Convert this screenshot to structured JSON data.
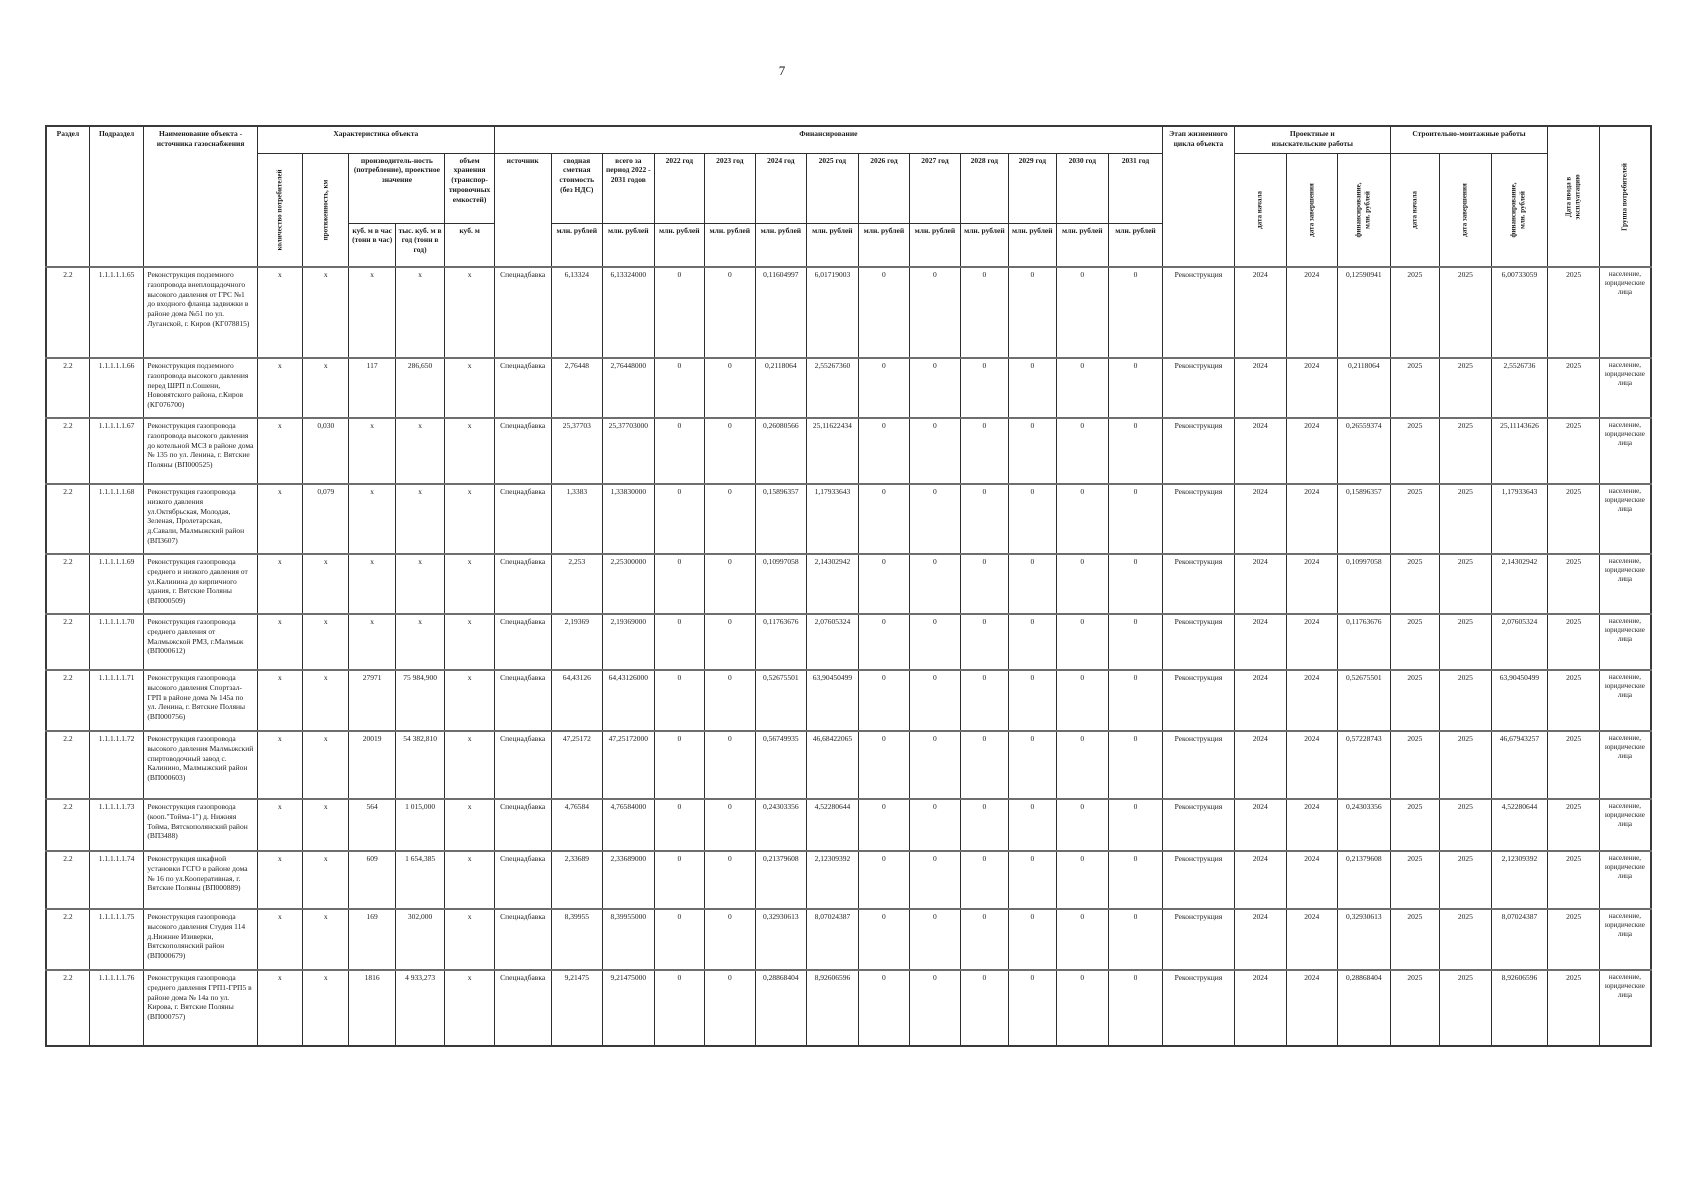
{
  "page_number": "7",
  "table": {
    "header": {
      "razdel": "Раздел",
      "podrazdel": "Подраздел",
      "object_name": "Наименование объекта - источника газоснабжения",
      "characteristics": "Характеристика объекта",
      "consumers_count": "количество потребителей",
      "length_km": "протяженность, км",
      "productivity": "производитель-ность (потребление), проектное значение",
      "m3_per_hour": "куб. м в час (тонн в час)",
      "thous_m3_per_year": "тыс. куб. м в год (тонн в год)",
      "storage_volume": "объем хранения (транспор-тировочных емкостей)",
      "m3": "куб. м",
      "financing": "Финансирование",
      "source": "источник",
      "estimated_cost": "сводная сметная стоимость (без НДС)",
      "total_period": "всего за период 2022 - 2031 годов",
      "mln_rub": "млн. рублей",
      "years": [
        "2022 год",
        "2023 год",
        "2024 год",
        "2025 год",
        "2026 год",
        "2027 год",
        "2028 год",
        "2029 год",
        "2030 год",
        "2031 год"
      ],
      "lifecycle_stage": "Этап жизненного цикла объекта",
      "survey_works": "Проектные и изыскательские работы",
      "construction_works": "Строительно-монтажные работы",
      "start_date": "дата начала",
      "end_date": "дата завершения",
      "financing_mln": "финансирование, млн. рублей",
      "commissioning_date": "Дата ввода в эксплуатацию",
      "consumer_group": "Группа потребителей"
    },
    "rows": [
      {
        "razdel": "2.2",
        "podrazdel": "1.1.1.1.1.65",
        "name": "Реконструкция подземного газопровода внеплощадочного высокого давления от ГРС №1 до входного фланца задвижки  в районе дома №51 по ул. Луганской, г. Киров (КГ078815)",
        "consumers": "х",
        "length": "х",
        "m3h": "х",
        "tm3y": "х",
        "storage": "х",
        "source": "Спецнадбавка",
        "cost": "6,13324",
        "total": "6,13324000",
        "y2022": "0",
        "y2023": "0",
        "y2024": "0,11604997",
        "y2025": "6,01719003",
        "y2026": "0",
        "y2027": "0",
        "y2028": "0",
        "y2029": "0",
        "y2030": "0",
        "y2031": "0",
        "stage": "Реконструкция",
        "pir_start": "2024",
        "pir_end": "2024",
        "pir_fin": "0,12590941",
        "smr_start": "2025",
        "smr_end": "2025",
        "smr_fin": "6,00733059",
        "commissioning": "2025",
        "group": "население, юридические лица"
      },
      {
        "razdel": "2.2",
        "podrazdel": "1.1.1.1.1.66",
        "name": "Реконструкция подземного газопровода высокого давления перед ШРП п.Сошени, Нововятского района, г.Киров (КГ076700)",
        "consumers": "х",
        "length": "х",
        "m3h": "117",
        "tm3y": "286,650",
        "storage": "х",
        "source": "Спецнадбавка",
        "cost": "2,76448",
        "total": "2,76448000",
        "y2022": "0",
        "y2023": "0",
        "y2024": "0,2118064",
        "y2025": "2,55267360",
        "y2026": "0",
        "y2027": "0",
        "y2028": "0",
        "y2029": "0",
        "y2030": "0",
        "y2031": "0",
        "stage": "Реконструкция",
        "pir_start": "2024",
        "pir_end": "2024",
        "pir_fin": "0,2118064",
        "smr_start": "2025",
        "smr_end": "2025",
        "smr_fin": "2,5526736",
        "commissioning": "2025",
        "group": "население, юридические лица"
      },
      {
        "razdel": "2.2",
        "podrazdel": "1.1.1.1.1.67",
        "name": "Реконструкция газопровода газопровода высокого давления до котельной МСЗ  в районе дома № 135 по ул. Ленина, г. Вятские Поляны (ВП000525)",
        "consumers": "х",
        "length": "0,030",
        "m3h": "х",
        "tm3y": "х",
        "storage": "х",
        "source": "Спецнадбавка",
        "cost": "25,37703",
        "total": "25,37703000",
        "y2022": "0",
        "y2023": "0",
        "y2024": "0,26080566",
        "y2025": "25,11622434",
        "y2026": "0",
        "y2027": "0",
        "y2028": "0",
        "y2029": "0",
        "y2030": "0",
        "y2031": "0",
        "stage": "Реконструкция",
        "pir_start": "2024",
        "pir_end": "2024",
        "pir_fin": "0,26559374",
        "smr_start": "2025",
        "smr_end": "2025",
        "smr_fin": "25,11143626",
        "commissioning": "2025",
        "group": "население, юридические лица"
      },
      {
        "razdel": "2.2",
        "podrazdel": "1.1.1.1.1.68",
        "name": "Реконструкция газопровода низкого давления ул.Октябрьская, Молодая, Зеленая, Пролетарская, д.Савали, Малмыжский район (ВП3607)",
        "consumers": "х",
        "length": "0,079",
        "m3h": "х",
        "tm3y": "х",
        "storage": "х",
        "source": "Спецнадбавка",
        "cost": "1,3383",
        "total": "1,33830000",
        "y2022": "0",
        "y2023": "0",
        "y2024": "0,15896357",
        "y2025": "1,17933643",
        "y2026": "0",
        "y2027": "0",
        "y2028": "0",
        "y2029": "0",
        "y2030": "0",
        "y2031": "0",
        "stage": "Реконструкция",
        "pir_start": "2024",
        "pir_end": "2024",
        "pir_fin": "0,15896357",
        "smr_start": "2025",
        "smr_end": "2025",
        "smr_fin": "1,17933643",
        "commissioning": "2025",
        "group": "население, юридические лица"
      },
      {
        "razdel": "2.2",
        "podrazdel": "1.1.1.1.1.69",
        "name": "Реконструкция газопровода среднего и низкого давления от ул.Калинина до кирпичного здания, г. Вятские Поляны (ВП000509)",
        "consumers": "х",
        "length": "х",
        "m3h": "х",
        "tm3y": "х",
        "storage": "х",
        "source": "Спецнадбавка",
        "cost": "2,253",
        "total": "2,25300000",
        "y2022": "0",
        "y2023": "0",
        "y2024": "0,10997058",
        "y2025": "2,14302942",
        "y2026": "0",
        "y2027": "0",
        "y2028": "0",
        "y2029": "0",
        "y2030": "0",
        "y2031": "0",
        "stage": "Реконструкция",
        "pir_start": "2024",
        "pir_end": "2024",
        "pir_fin": "0,10997058",
        "smr_start": "2025",
        "smr_end": "2025",
        "smr_fin": "2,14302942",
        "commissioning": "2025",
        "group": "население, юридические лица"
      },
      {
        "razdel": "2.2",
        "podrazdel": "1.1.1.1.1.70",
        "name": "Реконструкция газопровода среднего давления от Малмыжской РМЗ, г.Малмыж (ВП000612)",
        "consumers": "х",
        "length": "х",
        "m3h": "х",
        "tm3y": "х",
        "storage": "х",
        "source": "Спецнадбавка",
        "cost": "2,19369",
        "total": "2,19369000",
        "y2022": "0",
        "y2023": "0",
        "y2024": "0,11763676",
        "y2025": "2,07605324",
        "y2026": "0",
        "y2027": "0",
        "y2028": "0",
        "y2029": "0",
        "y2030": "0",
        "y2031": "0",
        "stage": "Реконструкция",
        "pir_start": "2024",
        "pir_end": "2024",
        "pir_fin": "0,11763676",
        "smr_start": "2025",
        "smr_end": "2025",
        "smr_fin": "2,07605324",
        "commissioning": "2025",
        "group": "население, юридические лица"
      },
      {
        "razdel": "2.2",
        "podrazdel": "1.1.1.1.1.71",
        "name": "Реконструкция газопровода высокого давления Спортзал-ГРП в районе дома № 145а по ул. Ленина, г. Вятские Поляны (ВП000756)",
        "consumers": "х",
        "length": "х",
        "m3h": "27971",
        "tm3y": "75 984,900",
        "storage": "х",
        "source": "Спецнадбавка",
        "cost": "64,43126",
        "total": "64,43126000",
        "y2022": "0",
        "y2023": "0",
        "y2024": "0,52675501",
        "y2025": "63,90450499",
        "y2026": "0",
        "y2027": "0",
        "y2028": "0",
        "y2029": "0",
        "y2030": "0",
        "y2031": "0",
        "stage": "Реконструкция",
        "pir_start": "2024",
        "pir_end": "2024",
        "pir_fin": "0,52675501",
        "smr_start": "2025",
        "smr_end": "2025",
        "smr_fin": "63,90450499",
        "commissioning": "2025",
        "group": "население, юридические лица"
      },
      {
        "razdel": "2.2",
        "podrazdel": "1.1.1.1.1.72",
        "name": "Реконструкция газопровода высокого давления Малмыжский спиртоводочный завод с. Калинино, Малмыжский район (ВП000603)",
        "consumers": "х",
        "length": "х",
        "m3h": "20019",
        "tm3y": "54 382,810",
        "storage": "х",
        "source": "Спецнадбавка",
        "cost": "47,25172",
        "total": "47,25172000",
        "y2022": "0",
        "y2023": "0",
        "y2024": "0,56749935",
        "y2025": "46,68422065",
        "y2026": "0",
        "y2027": "0",
        "y2028": "0",
        "y2029": "0",
        "y2030": "0",
        "y2031": "0",
        "stage": "Реконструкция",
        "pir_start": "2024",
        "pir_end": "2024",
        "pir_fin": "0,57228743",
        "smr_start": "2025",
        "smr_end": "2025",
        "smr_fin": "46,67943257",
        "commissioning": "2025",
        "group": "население, юридические лица"
      },
      {
        "razdel": "2.2",
        "podrazdel": "1.1.1.1.1.73",
        "name": "Реконструкция газопровода (кооп.\"Тойма-1\") д. Нижняя Тойма, Вятскополянский район (ВП3488)",
        "consumers": "х",
        "length": "х",
        "m3h": "564",
        "tm3y": "1 015,000",
        "storage": "х",
        "source": "Спецнадбавка",
        "cost": "4,76584",
        "total": "4,76584000",
        "y2022": "0",
        "y2023": "0",
        "y2024": "0,24303356",
        "y2025": "4,52280644",
        "y2026": "0",
        "y2027": "0",
        "y2028": "0",
        "y2029": "0",
        "y2030": "0",
        "y2031": "0",
        "stage": "Реконструкция",
        "pir_start": "2024",
        "pir_end": "2024",
        "pir_fin": "0,24303356",
        "smr_start": "2025",
        "smr_end": "2025",
        "smr_fin": "4,52280644",
        "commissioning": "2025",
        "group": "население, юридические лица"
      },
      {
        "razdel": "2.2",
        "podrazdel": "1.1.1.1.1.74",
        "name": "Реконструкция  шкафной установки ГСГО в районе дома № 16 по ул.Кооперативная, г. Вятские Поляны (ВП000889)",
        "consumers": "х",
        "length": "х",
        "m3h": "609",
        "tm3y": "1 654,385",
        "storage": "х",
        "source": "Спецнадбавка",
        "cost": "2,33689",
        "total": "2,33689000",
        "y2022": "0",
        "y2023": "0",
        "y2024": "0,21379608",
        "y2025": "2,12309392",
        "y2026": "0",
        "y2027": "0",
        "y2028": "0",
        "y2029": "0",
        "y2030": "0",
        "y2031": "0",
        "stage": "Реконструкция",
        "pir_start": "2024",
        "pir_end": "2024",
        "pir_fin": "0,21379608",
        "smr_start": "2025",
        "smr_end": "2025",
        "smr_fin": "2,12309392",
        "commissioning": "2025",
        "group": "население, юридические лица"
      },
      {
        "razdel": "2.2",
        "podrazdel": "1.1.1.1.1.75",
        "name": "Реконструкция газопровода высокого давления Студия 114 д.Нижние Изиверки, Вятскополянский район (ВП000679)",
        "consumers": "х",
        "length": "х",
        "m3h": "169",
        "tm3y": "302,000",
        "storage": "х",
        "source": "Спецнадбавка",
        "cost": "8,39955",
        "total": "8,39955000",
        "y2022": "0",
        "y2023": "0",
        "y2024": "0,32930613",
        "y2025": "8,07024387",
        "y2026": "0",
        "y2027": "0",
        "y2028": "0",
        "y2029": "0",
        "y2030": "0",
        "y2031": "0",
        "stage": "Реконструкция",
        "pir_start": "2024",
        "pir_end": "2024",
        "pir_fin": "0,32930613",
        "smr_start": "2025",
        "smr_end": "2025",
        "smr_fin": "8,07024387",
        "commissioning": "2025",
        "group": "население, юридические лица"
      },
      {
        "razdel": "2.2",
        "podrazdel": "1.1.1.1.1.76",
        "name": "Реконструкция газопровода среднего давления ГРП1-ГРП5 в районе дома № 14а по ул. Кирова, г. Вятские Поляны (ВП000757)",
        "consumers": "х",
        "length": "х",
        "m3h": "1816",
        "tm3y": "4 933,273",
        "storage": "х",
        "source": "Спецнадбавка",
        "cost": "9,21475",
        "total": "9,21475000",
        "y2022": "0",
        "y2023": "0",
        "y2024": "0,28868404",
        "y2025": "8,92606596",
        "y2026": "0",
        "y2027": "0",
        "y2028": "0",
        "y2029": "0",
        "y2030": "0",
        "y2031": "0",
        "stage": "Реконструкция",
        "pir_start": "2024",
        "pir_end": "2024",
        "pir_fin": "0,28868404",
        "smr_start": "2025",
        "smr_end": "2025",
        "smr_fin": "8,92606596",
        "commissioning": "2025",
        "group": "население, юридические лица"
      }
    ]
  }
}
